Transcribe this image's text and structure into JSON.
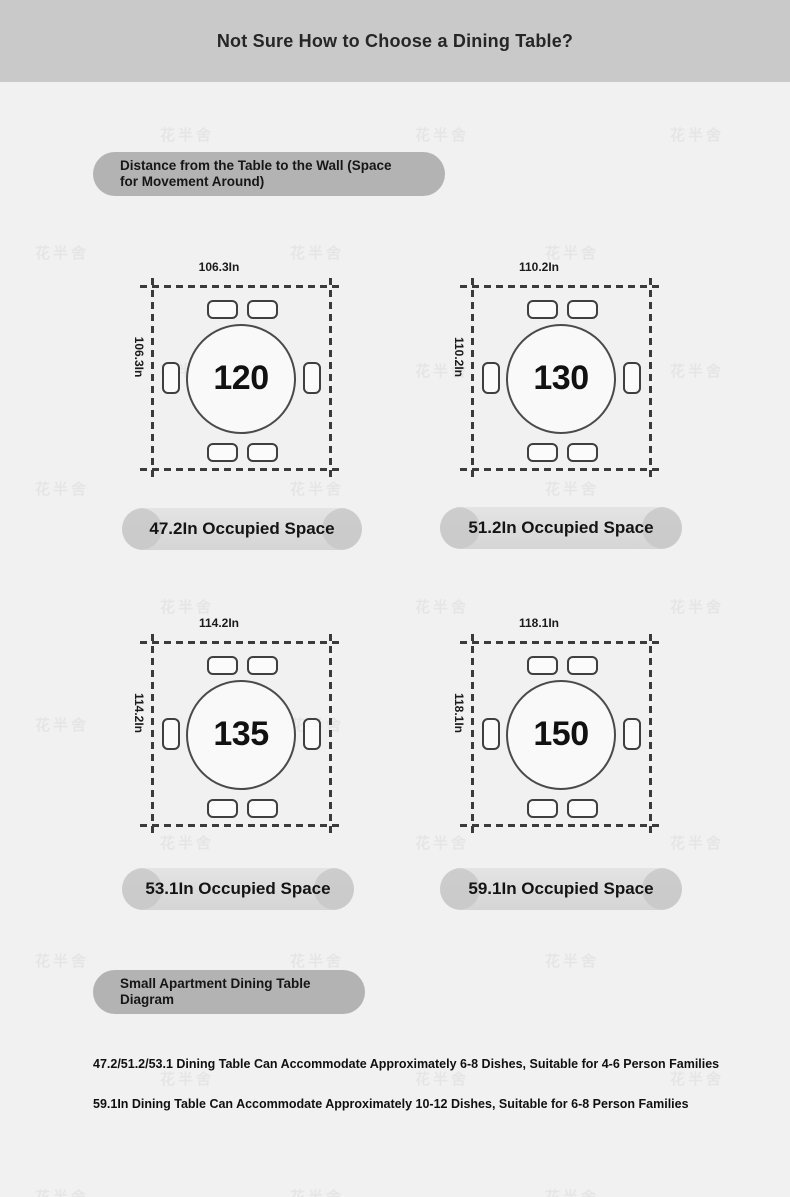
{
  "header": {
    "title": "Not Sure How to Choose a Dining Table?"
  },
  "section_pills": {
    "distance": "Distance from the Table to the Wall (Space for Movement Around)",
    "small_apartment": "Small Apartment Dining Table Diagram"
  },
  "diagrams": [
    {
      "table_size": "120",
      "width_label": "106.3In",
      "height_label": "106.3In",
      "occupied_label": "47.2In Occupied Space"
    },
    {
      "table_size": "130",
      "width_label": "110.2In",
      "height_label": "110.2In",
      "occupied_label": "51.2In Occupied Space"
    },
    {
      "table_size": "135",
      "width_label": "114.2In",
      "height_label": "114.2In",
      "occupied_label": "53.1In Occupied Space"
    },
    {
      "table_size": "150",
      "width_label": "118.1In",
      "height_label": "118.1In",
      "occupied_label": "59.1In Occupied Space"
    }
  ],
  "notes": [
    "47.2/51.2/53.1 Dining Table Can Accommodate Approximately 6-8 Dishes, Suitable for 4-6 Person Families",
    "59.1In Dining Table Can Accommodate Approximately 10-12 Dishes, Suitable for 6-8 Person Families"
  ],
  "watermark": {
    "text": "花半舍"
  },
  "colors": {
    "header_bg": "#c9c9c9",
    "page_bg": "#f1f1f1",
    "section_pill_bg": "#b3b3b3",
    "occupied_pill_mid": "#dcdcdc",
    "occupied_pill_ends": "#c7c7c7",
    "dashed_line": "#3b3b3b",
    "text_dark": "#141414"
  }
}
